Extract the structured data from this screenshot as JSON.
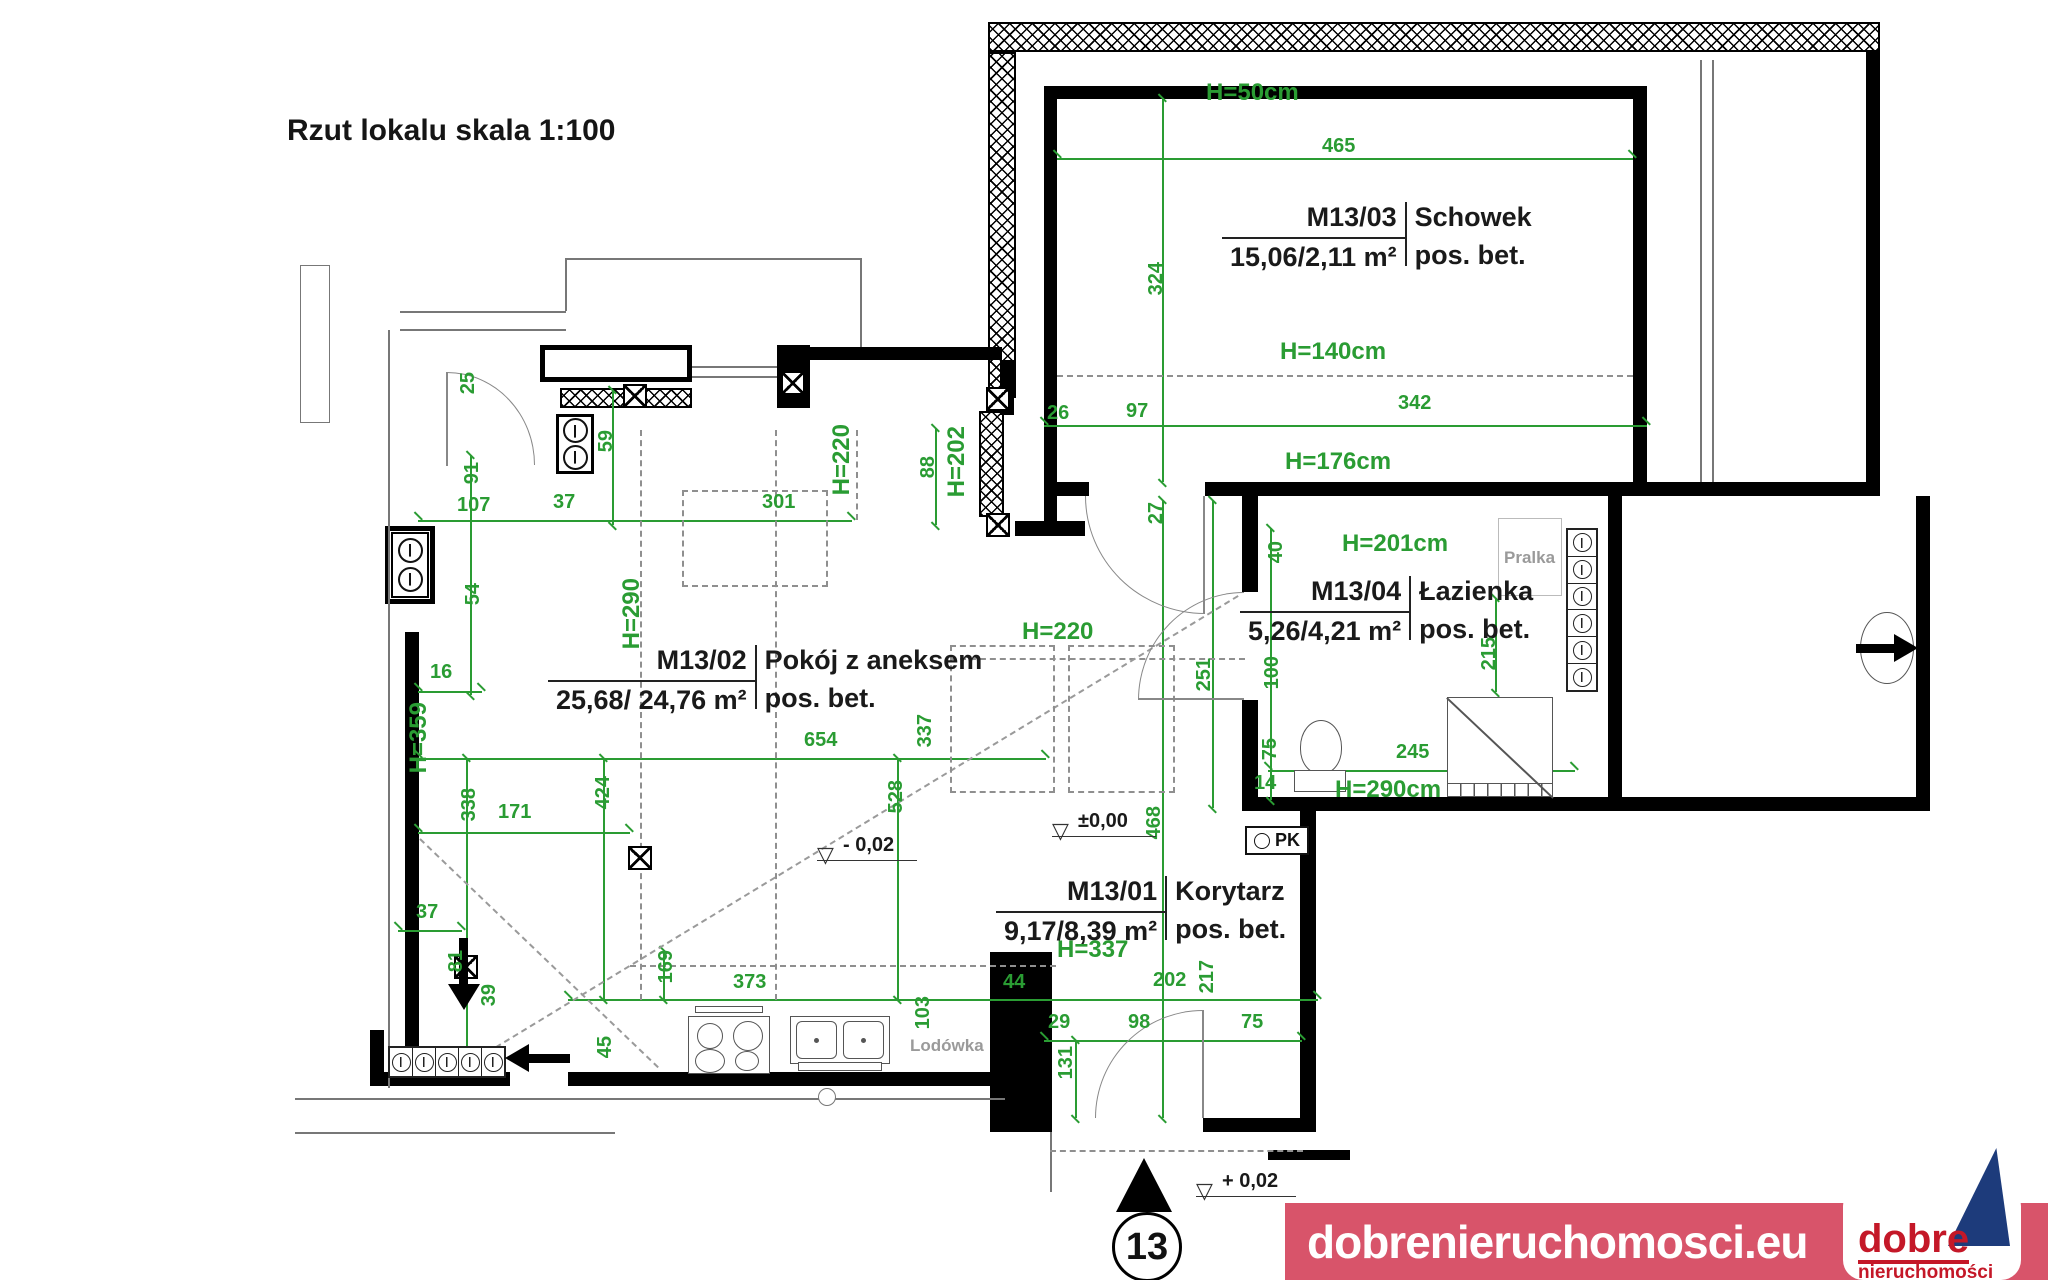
{
  "title": "Rzut lokalu skala 1:100",
  "colors": {
    "dimension_green": "#2a9c33",
    "wall_black": "#000000",
    "muted_gray": "#9a9a9a",
    "logo_banner_red": "#d8546a",
    "logo_text_red": "#c41828",
    "logo_navy": "#1d3b7b"
  },
  "rooms": [
    {
      "id": "M13/03",
      "name": "Schowek",
      "area": "15,06/2,11 m²",
      "floor": "pos. bet.",
      "x": 1222,
      "y": 202,
      "bar": 64
    },
    {
      "id": "M13/04",
      "name": "Łazienka",
      "area": "5,26/4,21 m²",
      "floor": "pos. bet.",
      "x": 1240,
      "y": 576,
      "bar": 64
    },
    {
      "id": "M13/02",
      "name": "Pokój z aneksem",
      "area": "25,68/ 24,76 m²",
      "floor": "pos. bet.",
      "x": 548,
      "y": 645,
      "bar": 64
    },
    {
      "id": "M13/01",
      "name": "Korytarz",
      "area": "9,17/8,39 m²",
      "floor": "pos. bet.",
      "x": 996,
      "y": 876,
      "bar": 64
    }
  ],
  "dimensions": [
    {
      "t": "465",
      "x": 1322,
      "y": 136
    },
    {
      "t": "324",
      "x": 1146,
      "y": 262,
      "v": true
    },
    {
      "t": "26",
      "x": 1047,
      "y": 403
    },
    {
      "t": "97",
      "x": 1126,
      "y": 401
    },
    {
      "t": "342",
      "x": 1398,
      "y": 393
    },
    {
      "t": "27",
      "x": 1146,
      "y": 502,
      "v": true
    },
    {
      "t": "40",
      "x": 1266,
      "y": 541,
      "v": true
    },
    {
      "t": "215",
      "x": 1479,
      "y": 637,
      "v": true
    },
    {
      "t": "251",
      "x": 1194,
      "y": 658,
      "v": true
    },
    {
      "t": "100",
      "x": 1262,
      "y": 656,
      "v": true
    },
    {
      "t": "75",
      "x": 1260,
      "y": 738,
      "v": true
    },
    {
      "t": "14",
      "x": 1254,
      "y": 773
    },
    {
      "t": "245",
      "x": 1396,
      "y": 742
    },
    {
      "t": "468",
      "x": 1144,
      "y": 806,
      "v": true
    },
    {
      "t": "44",
      "x": 1003,
      "y": 972
    },
    {
      "t": "202",
      "x": 1153,
      "y": 970
    },
    {
      "t": "217",
      "x": 1197,
      "y": 960,
      "v": true
    },
    {
      "t": "29",
      "x": 1048,
      "y": 1012
    },
    {
      "t": "98",
      "x": 1128,
      "y": 1012
    },
    {
      "t": "75",
      "x": 1241,
      "y": 1012
    },
    {
      "t": "131",
      "x": 1056,
      "y": 1046,
      "v": true
    },
    {
      "t": "103",
      "x": 913,
      "y": 996,
      "v": true
    },
    {
      "t": "373",
      "x": 733,
      "y": 972
    },
    {
      "t": "169",
      "x": 656,
      "y": 950,
      "v": true
    },
    {
      "t": "45",
      "x": 595,
      "y": 1036,
      "v": true
    },
    {
      "t": "39",
      "x": 479,
      "y": 984,
      "v": true
    },
    {
      "t": "81",
      "x": 446,
      "y": 950,
      "v": true
    },
    {
      "t": "37",
      "x": 416,
      "y": 902
    },
    {
      "t": "171",
      "x": 498,
      "y": 802
    },
    {
      "t": "338",
      "x": 459,
      "y": 788,
      "v": true
    },
    {
      "t": "424",
      "x": 593,
      "y": 776,
      "v": true
    },
    {
      "t": "528",
      "x": 886,
      "y": 780,
      "v": true
    },
    {
      "t": "337",
      "x": 915,
      "y": 714,
      "v": true
    },
    {
      "t": "654",
      "x": 804,
      "y": 730
    },
    {
      "t": "16",
      "x": 430,
      "y": 662
    },
    {
      "t": "54",
      "x": 463,
      "y": 583,
      "v": true
    },
    {
      "t": "107",
      "x": 457,
      "y": 495
    },
    {
      "t": "37",
      "x": 553,
      "y": 492
    },
    {
      "t": "301",
      "x": 762,
      "y": 492
    },
    {
      "t": "91",
      "x": 462,
      "y": 462,
      "v": true
    },
    {
      "t": "25",
      "x": 458,
      "y": 372,
      "v": true
    },
    {
      "t": "59",
      "x": 596,
      "y": 430,
      "v": true
    },
    {
      "t": "88",
      "x": 918,
      "y": 456,
      "v": true
    }
  ],
  "heights": [
    {
      "t": "H=50cm",
      "x": 1206,
      "y": 81
    },
    {
      "t": "H=140cm",
      "x": 1280,
      "y": 340
    },
    {
      "t": "H=176cm",
      "x": 1285,
      "y": 450
    },
    {
      "t": "H=201cm",
      "x": 1342,
      "y": 532
    },
    {
      "t": "H=220",
      "x": 1022,
      "y": 620
    },
    {
      "t": "H=290cm",
      "x": 1335,
      "y": 778
    },
    {
      "t": "H=337",
      "x": 1057,
      "y": 938
    },
    {
      "t": "H=220",
      "x": 830,
      "y": 424,
      "v": true
    },
    {
      "t": "H=202",
      "x": 945,
      "y": 426,
      "v": true
    },
    {
      "t": "H=290",
      "x": 620,
      "y": 578,
      "v": true
    },
    {
      "t": "H=359",
      "x": 407,
      "y": 702,
      "v": true
    }
  ],
  "levels": [
    {
      "t": "±0,00",
      "x": 1078,
      "y": 810,
      "w": 104
    },
    {
      "t": "- 0,02",
      "x": 843,
      "y": 834,
      "w": 100
    },
    {
      "t": "+ 0,02",
      "x": 1222,
      "y": 1170,
      "w": 100
    }
  ],
  "labels": {
    "pralka": "Pralka",
    "lodowka": "Lodówka",
    "pk": "PK",
    "unit_number": "13"
  },
  "footer": {
    "website": "dobrenieruchomosci.eu",
    "brand_line1": "dobre",
    "brand_line2": "nieruchomości"
  }
}
